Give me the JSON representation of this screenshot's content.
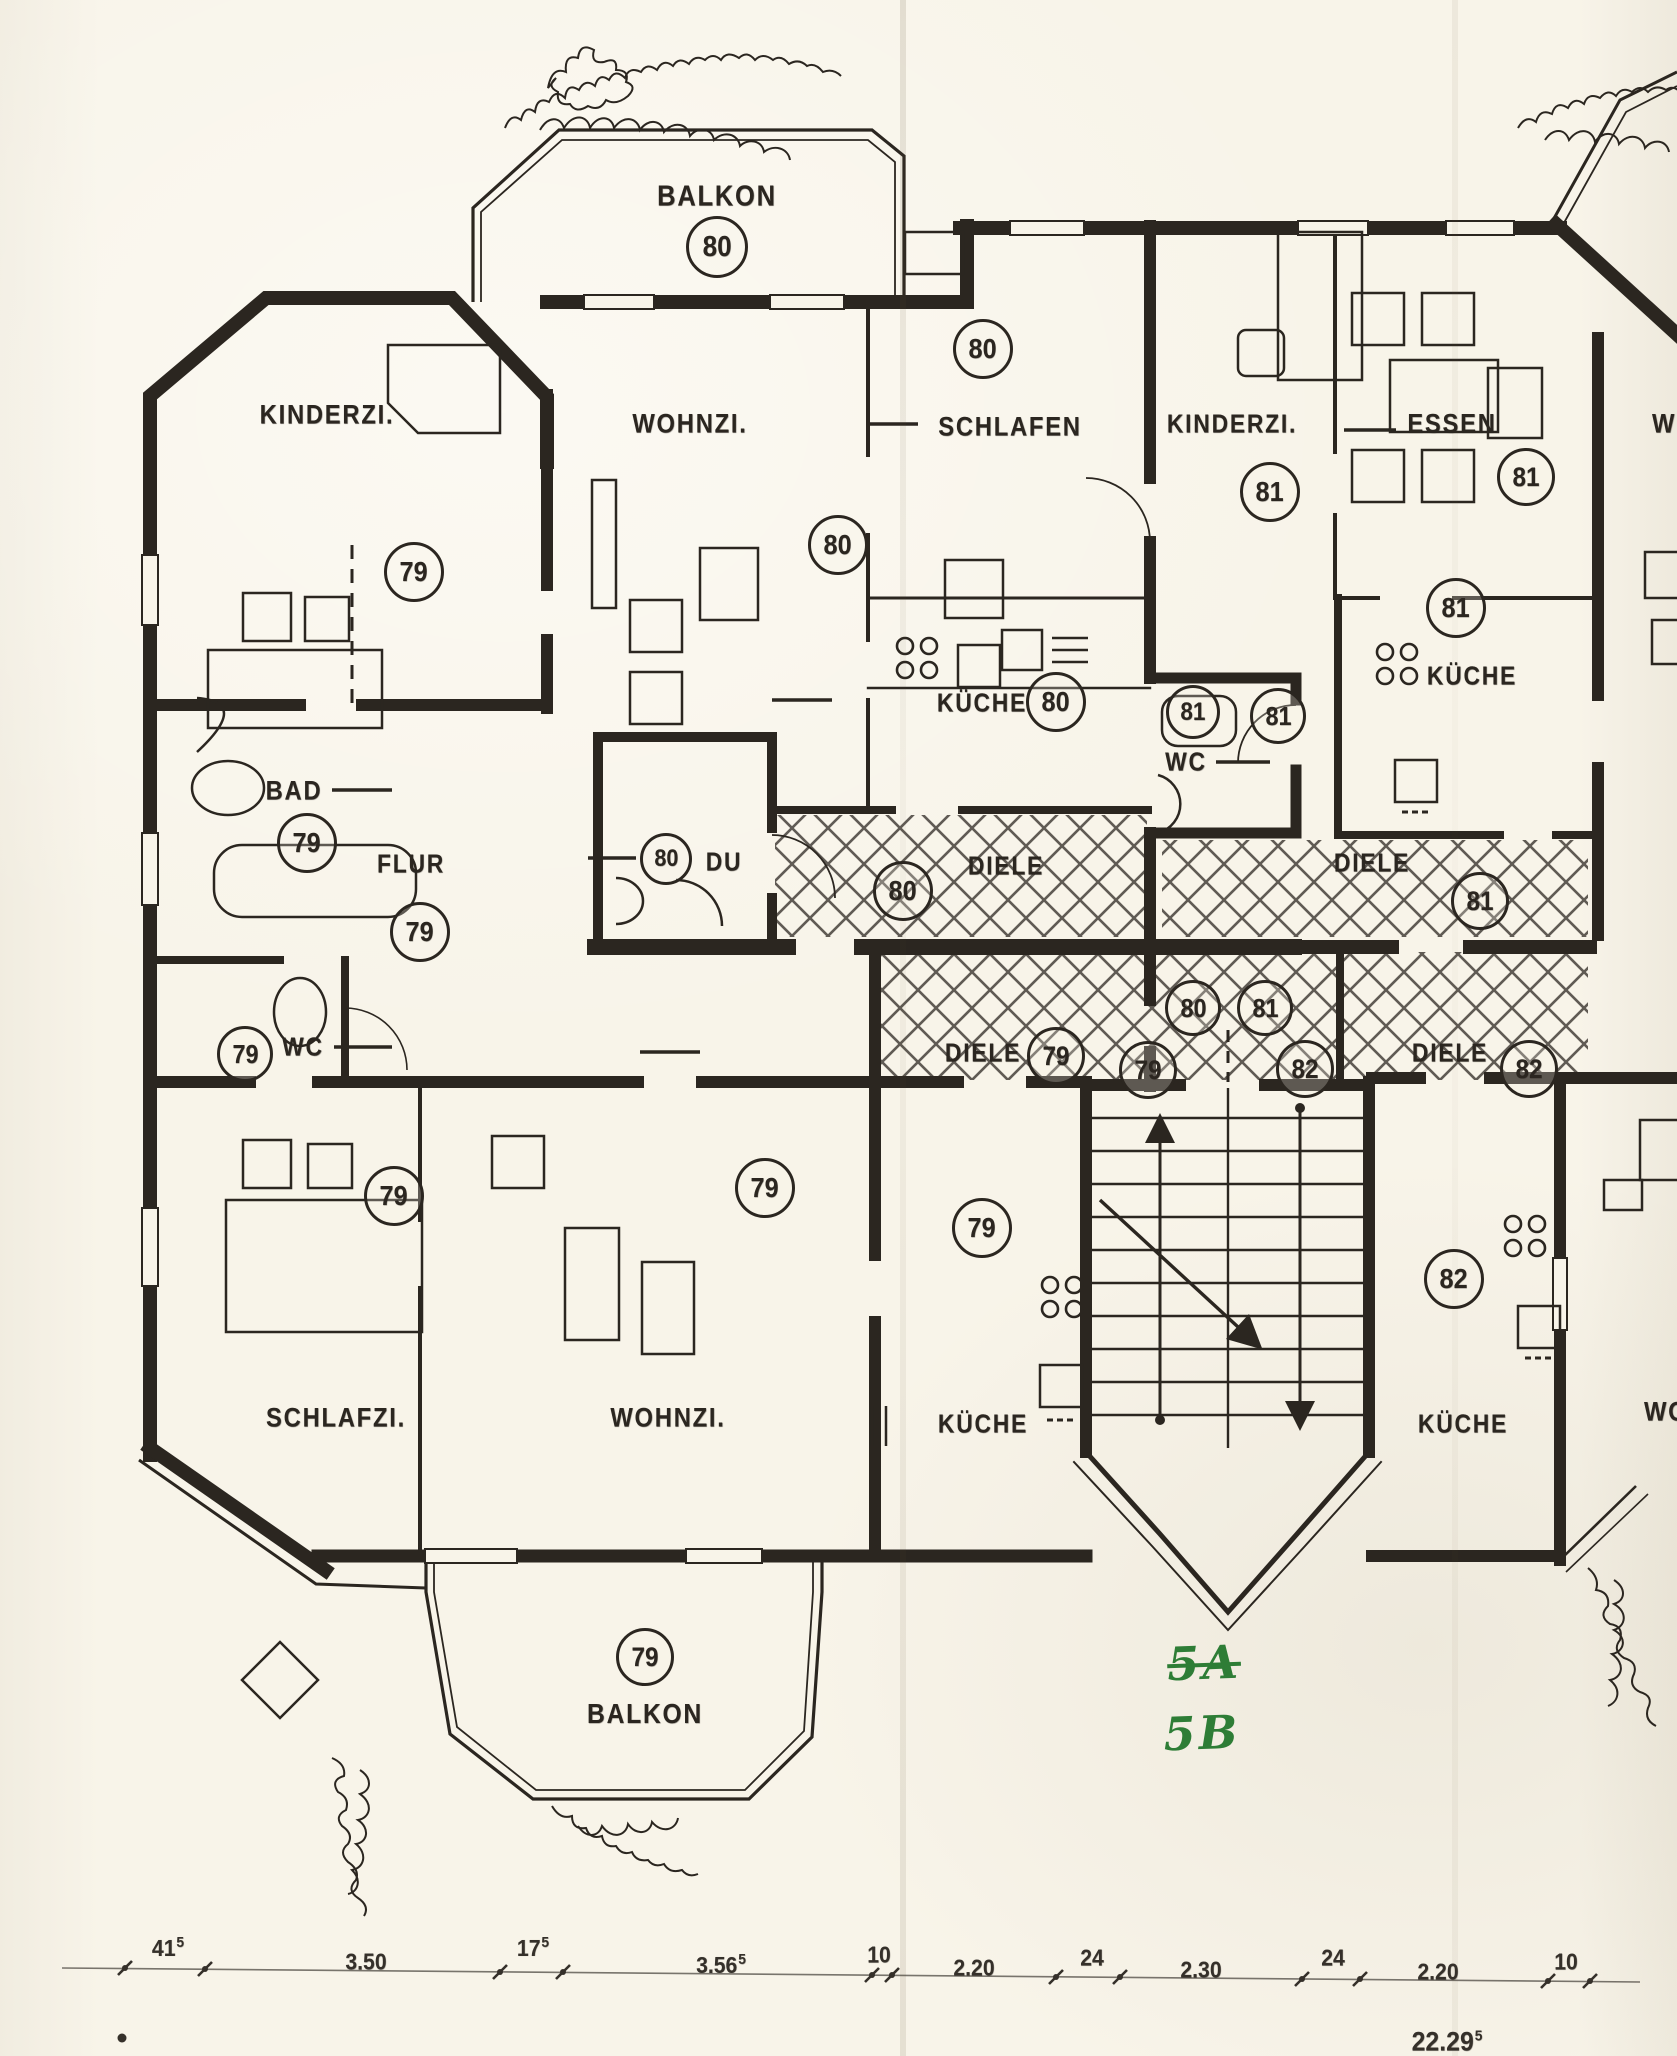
{
  "page": {
    "kind": "scanned architectural floor plan"
  },
  "colors": {
    "paper": "#f8f4e9",
    "ink": "#2b2620",
    "hatch": "#45403a",
    "green_ink": "#2e7d36"
  },
  "icons": [
    "stove-burners-icon",
    "sink-icon",
    "toilet-icon",
    "washbasin-icon",
    "bathtub-icon",
    "stairs-up-arrow-icon",
    "stairs-down-arrow-icon",
    "plant-scribble-icon",
    "door-swing-icon",
    "diamond-planter-icon"
  ],
  "plan": {
    "room_labels": [
      {
        "id": "balkon-top",
        "text": "BALKON",
        "x": 717,
        "y": 197,
        "fs": 29
      },
      {
        "id": "kinderzi-79",
        "text": "KINDERZI.",
        "x": 327,
        "y": 415,
        "fs": 27
      },
      {
        "id": "wohnzi-80",
        "text": "WOHNZI.",
        "x": 690,
        "y": 424,
        "fs": 27
      },
      {
        "id": "schlafen-80",
        "text": "SCHLAFEN",
        "x": 1010,
        "y": 427,
        "fs": 27
      },
      {
        "id": "kinderzi-81",
        "text": "KINDERZI.",
        "x": 1232,
        "y": 424,
        "fs": 26
      },
      {
        "id": "essen-81",
        "text": "ESSEN",
        "x": 1452,
        "y": 424,
        "fs": 27
      },
      {
        "id": "kueche-81",
        "text": "KÜCHE",
        "x": 1472,
        "y": 676,
        "fs": 26
      },
      {
        "id": "kueche-80",
        "text": "KÜCHE",
        "x": 982,
        "y": 703,
        "fs": 26
      },
      {
        "id": "wc-81",
        "text": "WC",
        "x": 1186,
        "y": 762,
        "fs": 26
      },
      {
        "id": "bad-79",
        "text": "BAD",
        "x": 294,
        "y": 791,
        "fs": 27
      },
      {
        "id": "flur-79",
        "text": "FLUR",
        "x": 411,
        "y": 864,
        "fs": 26
      },
      {
        "id": "du-80",
        "text": "DU",
        "x": 724,
        "y": 862,
        "fs": 26
      },
      {
        "id": "diele-80",
        "text": "DIELE",
        "x": 1006,
        "y": 866,
        "fs": 26
      },
      {
        "id": "diele-81",
        "text": "DIELE",
        "x": 1372,
        "y": 863,
        "fs": 26
      },
      {
        "id": "wc-79",
        "text": "WC",
        "x": 303,
        "y": 1047,
        "fs": 26
      },
      {
        "id": "diele-79",
        "text": "DIELE",
        "x": 983,
        "y": 1053,
        "fs": 26
      },
      {
        "id": "diele-82",
        "text": "DIELE",
        "x": 1450,
        "y": 1053,
        "fs": 26
      },
      {
        "id": "schlafzi-79",
        "text": "SCHLAFZI.",
        "x": 336,
        "y": 1418,
        "fs": 27
      },
      {
        "id": "wohnzi-79",
        "text": "WOHNZI.",
        "x": 668,
        "y": 1418,
        "fs": 27
      },
      {
        "id": "kueche-79",
        "text": "KÜCHE",
        "x": 983,
        "y": 1424,
        "fs": 26
      },
      {
        "id": "kueche-82",
        "text": "KÜCHE",
        "x": 1463,
        "y": 1424,
        "fs": 26
      },
      {
        "id": "balkon-79",
        "text": "BALKON",
        "x": 645,
        "y": 1714,
        "fs": 28
      }
    ],
    "partial_labels": [
      {
        "id": "wohnzi-right-top",
        "text": "WOHNZI.",
        "x": 1652,
        "y": 424
      },
      {
        "id": "wohnzi-right-bottom",
        "text": "WOHNZI.",
        "x": 1644,
        "y": 1412
      }
    ],
    "unit_circles": [
      {
        "n": "80",
        "x": 717,
        "y": 247,
        "d": 56
      },
      {
        "n": "80",
        "x": 983,
        "y": 349,
        "d": 54
      },
      {
        "n": "80",
        "x": 838,
        "y": 545,
        "d": 54
      },
      {
        "n": "79",
        "x": 414,
        "y": 572,
        "d": 54
      },
      {
        "n": "81",
        "x": 1270,
        "y": 492,
        "d": 54
      },
      {
        "n": "81",
        "x": 1526,
        "y": 477,
        "d": 52
      },
      {
        "n": "81",
        "x": 1456,
        "y": 608,
        "d": 54
      },
      {
        "n": "80",
        "x": 1056,
        "y": 702,
        "d": 54
      },
      {
        "n": "81",
        "x": 1193,
        "y": 712,
        "d": 48
      },
      {
        "n": "81",
        "x": 1278,
        "y": 716,
        "d": 50
      },
      {
        "n": "79",
        "x": 307,
        "y": 843,
        "d": 54
      },
      {
        "n": "79",
        "x": 420,
        "y": 932,
        "d": 54
      },
      {
        "n": "80",
        "x": 666,
        "y": 859,
        "d": 46
      },
      {
        "n": "80",
        "x": 903,
        "y": 891,
        "d": 54
      },
      {
        "n": "81",
        "x": 1480,
        "y": 901,
        "d": 52
      },
      {
        "n": "79",
        "x": 245,
        "y": 1054,
        "d": 50
      },
      {
        "n": "80",
        "x": 1193,
        "y": 1008,
        "d": 50
      },
      {
        "n": "81",
        "x": 1265,
        "y": 1008,
        "d": 50
      },
      {
        "n": "79",
        "x": 1056,
        "y": 1056,
        "d": 52
      },
      {
        "n": "79",
        "x": 1148,
        "y": 1070,
        "d": 52
      },
      {
        "n": "82",
        "x": 1305,
        "y": 1069,
        "d": 52
      },
      {
        "n": "82",
        "x": 1529,
        "y": 1069,
        "d": 52
      },
      {
        "n": "79",
        "x": 394,
        "y": 1196,
        "d": 54
      },
      {
        "n": "79",
        "x": 765,
        "y": 1188,
        "d": 54
      },
      {
        "n": "79",
        "x": 982,
        "y": 1228,
        "d": 54
      },
      {
        "n": "82",
        "x": 1454,
        "y": 1279,
        "d": 54
      },
      {
        "n": "79",
        "x": 645,
        "y": 1657,
        "d": 52
      }
    ],
    "handwritten": [
      {
        "id": "note-5a",
        "text": "5A",
        "x": 1204,
        "y": 1663,
        "struck": true
      },
      {
        "id": "note-5b",
        "text": "5B",
        "x": 1202,
        "y": 1733,
        "struck": false
      }
    ],
    "dimensions": {
      "items": [
        {
          "v": "41",
          "sup": "5",
          "x": 168,
          "y": 1948
        },
        {
          "v": "3.50",
          "sup": "",
          "x": 366,
          "y": 1962
        },
        {
          "v": "17",
          "sup": "5",
          "x": 533,
          "y": 1948
        },
        {
          "v": "3.56",
          "sup": "5",
          "x": 721,
          "y": 1965
        },
        {
          "v": "10",
          "sup": "",
          "x": 879,
          "y": 1955
        },
        {
          "v": "2.20",
          "sup": "",
          "x": 974,
          "y": 1968
        },
        {
          "v": "24",
          "sup": "",
          "x": 1092,
          "y": 1958
        },
        {
          "v": "2.30",
          "sup": "",
          "x": 1201,
          "y": 1970
        },
        {
          "v": "24",
          "sup": "",
          "x": 1333,
          "y": 1958
        },
        {
          "v": "2.20",
          "sup": "",
          "x": 1438,
          "y": 1972
        },
        {
          "v": "10",
          "sup": "",
          "x": 1566,
          "y": 1962
        }
      ],
      "partial_total": {
        "v": "22.29",
        "sup": "5",
        "x": 1447,
        "y": 2042
      }
    }
  }
}
